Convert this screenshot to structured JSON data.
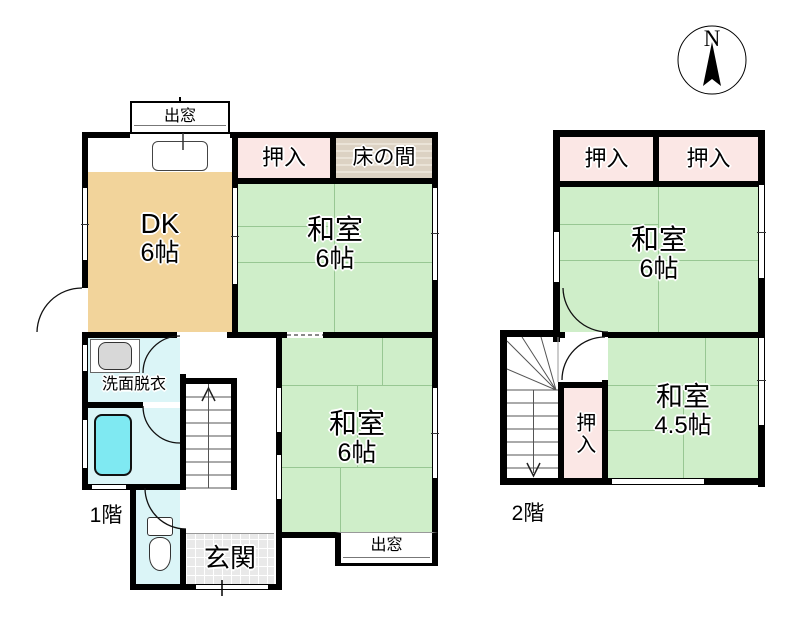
{
  "compass": {
    "north_label": "N"
  },
  "floor1": {
    "floor_label": "1階",
    "bay_window_top": "出窓",
    "bay_window_bottom": "出窓",
    "dk": {
      "name": "DK",
      "size": "6帖"
    },
    "closet": "押入",
    "tokonoma": "床の間",
    "washitsu_upper": {
      "name": "和室",
      "size": "6帖"
    },
    "washitsu_lower": {
      "name": "和室",
      "size": "6帖"
    },
    "washroom": "洗面脱衣",
    "entrance": "玄関"
  },
  "floor2": {
    "floor_label": "2階",
    "closet_left": "押入",
    "closet_right": "押入",
    "closet_lower": "押入",
    "washitsu_6": {
      "name": "和室",
      "size": "6帖"
    },
    "washitsu_45": {
      "name": "和室",
      "size": "4.5帖"
    }
  },
  "colors": {
    "tatami_green": "#cfeec9",
    "dk_tan": "#f2d49b",
    "closet_pink": "#fbe7e5",
    "tokonoma_beige": "#dcd2c3",
    "bath_cyan": "#dbf5f7",
    "bathtub_cyan": "#7fe9f2",
    "genkan_tile": "#e9e9e9",
    "wall_black": "#000000"
  }
}
